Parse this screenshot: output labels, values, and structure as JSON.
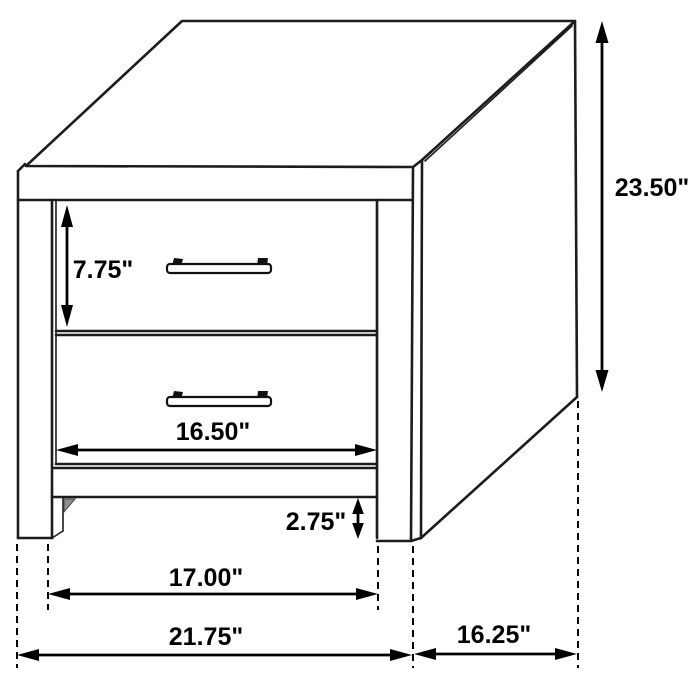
{
  "diagram": {
    "kind": "furniture-dimension-diagram",
    "dimensions": {
      "overall_height": "23.50\"",
      "top_drawer_height": "7.75\"",
      "drawer_width": "16.50\"",
      "base_clearance": "2.75\"",
      "inner_leg_width": "17.00\"",
      "overall_width": "21.75\"",
      "depth": "16.25\""
    },
    "colors": {
      "line": "#1c1c1c",
      "dimension": "#000000",
      "background": "#ffffff"
    }
  }
}
